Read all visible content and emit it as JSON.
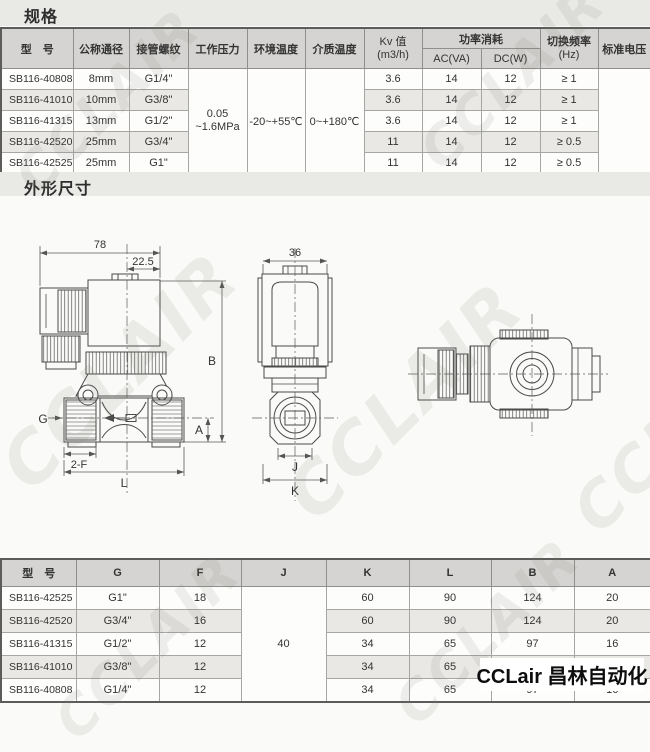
{
  "titles": {
    "spec": "规格",
    "dims": "外形尺寸"
  },
  "logo": {
    "text": "CCLair 昌林自动化"
  },
  "watermark": {
    "text": "CCLAIR"
  },
  "colors": {
    "page_bg": "#fafaf8",
    "band_bg": "#e9e9e6",
    "header_bg": "#d5d4d2",
    "stripe_bg": "#e9e8e5",
    "border_dark": "#5c5c5a",
    "logo_text": "#0d0d0d"
  },
  "spec_table": {
    "headers": {
      "model": "型　号",
      "diameter": "公称通径",
      "thread": "接管螺纹",
      "pressure": "工作压力",
      "ambient_temp": "环境温度",
      "medium_temp": "介质温度",
      "kv_line1": "Kv 值",
      "kv_line2": "(m3/h)",
      "power": "功率消耗",
      "ac": "AC(VA)",
      "dc": "DC(W)",
      "freq_line1": "切换频率",
      "freq_line2": "(Hz)",
      "voltage": "标准电压"
    },
    "merged": {
      "pressure_line1": "0.05",
      "pressure_line2": "~1.6MPa",
      "ambient_temp": "-20~+55℃",
      "medium_temp": "0~+180℃",
      "voltage": ""
    },
    "rows": [
      {
        "model": "SB116-40808",
        "diameter": "8mm",
        "thread": "G1/4\"",
        "kv": "3.6",
        "ac": "14",
        "dc": "12",
        "freq": "≥ 1"
      },
      {
        "model": "SB116-41010",
        "diameter": "10mm",
        "thread": "G3/8\"",
        "kv": "3.6",
        "ac": "14",
        "dc": "12",
        "freq": "≥ 1"
      },
      {
        "model": "SB116-41315",
        "diameter": "13mm",
        "thread": "G1/2\"",
        "kv": "3.6",
        "ac": "14",
        "dc": "12",
        "freq": "≥ 1"
      },
      {
        "model": "SB116-42520",
        "diameter": "25mm",
        "thread": "G3/4\"",
        "kv": "11",
        "ac": "14",
        "dc": "12",
        "freq": "≥ 0.5"
      },
      {
        "model": "SB116-42525",
        "diameter": "25mm",
        "thread": "G1\"",
        "kv": "11",
        "ac": "14",
        "dc": "12",
        "freq": "≥ 0.5"
      }
    ]
  },
  "dim_table": {
    "headers": {
      "model": "型　号",
      "g": "G",
      "f": "F",
      "j": "J",
      "k": "K",
      "l": "L",
      "b": "B",
      "a": "A"
    },
    "j_merged": "40",
    "rows": [
      {
        "model": "SB116-42525",
        "g": "G1\"",
        "f": "18",
        "k": "60",
        "l": "90",
        "b": "124",
        "a": "20"
      },
      {
        "model": "SB116-42520",
        "g": "G3/4\"",
        "f": "16",
        "k": "60",
        "l": "90",
        "b": "124",
        "a": "20"
      },
      {
        "model": "SB116-41315",
        "g": "G1/2\"",
        "f": "12",
        "k": "34",
        "l": "65",
        "b": "97",
        "a": "16"
      },
      {
        "model": "SB116-41010",
        "g": "G3/8\"",
        "f": "12",
        "k": "34",
        "l": "65",
        "b": "97",
        "a": "16"
      },
      {
        "model": "SB116-40808",
        "g": "G1/4\"",
        "f": "12",
        "k": "34",
        "l": "65",
        "b": "97",
        "a": "16"
      }
    ]
  },
  "drawing_labels": {
    "side_width": "78",
    "side_offset": "22.5",
    "b": "B",
    "g": "G",
    "a": "A",
    "f2": "2-F",
    "l": "L",
    "front_width": "36",
    "j": "J",
    "k": "K"
  }
}
